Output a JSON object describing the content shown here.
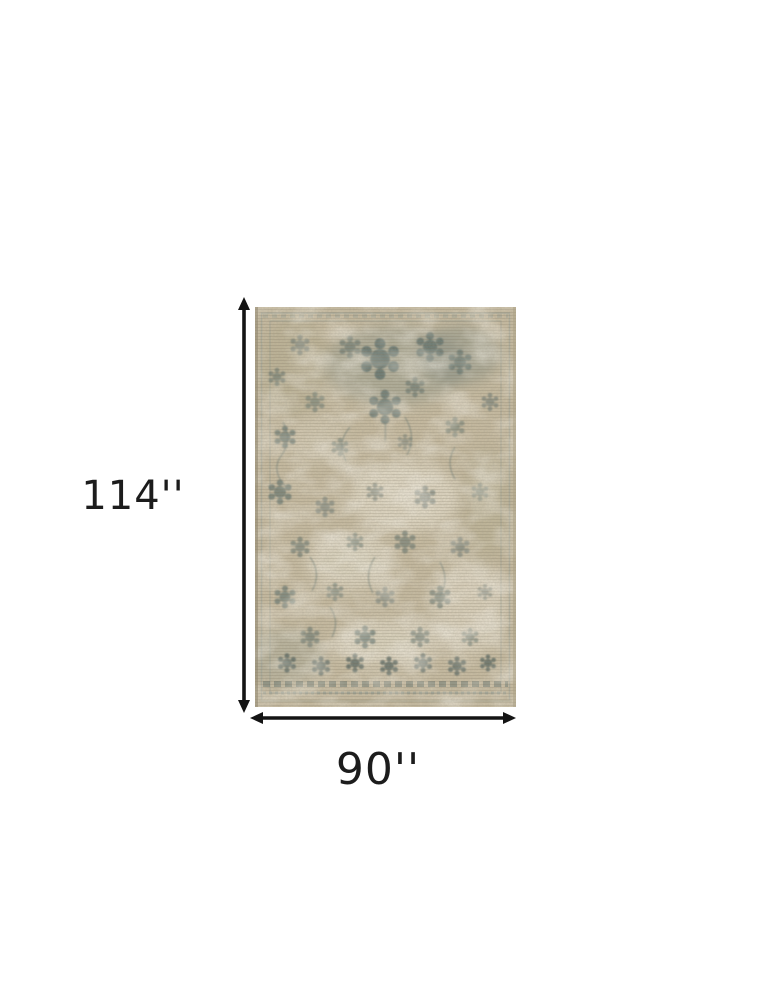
{
  "diagram": {
    "image_description": "distressed beige and grey-blue oriental area rug shown with overall dimensions",
    "height_label": "114''",
    "width_label": "90''"
  },
  "colors": {
    "page_bg": "#ffffff",
    "dimension_line": "#141414",
    "label_text": "#1c1c1c",
    "rug_base": "#c9bda2",
    "rug_pattern": "#5f706c",
    "rug_worn": "#ebe4d2",
    "rug_band": "#5e6f6a"
  }
}
